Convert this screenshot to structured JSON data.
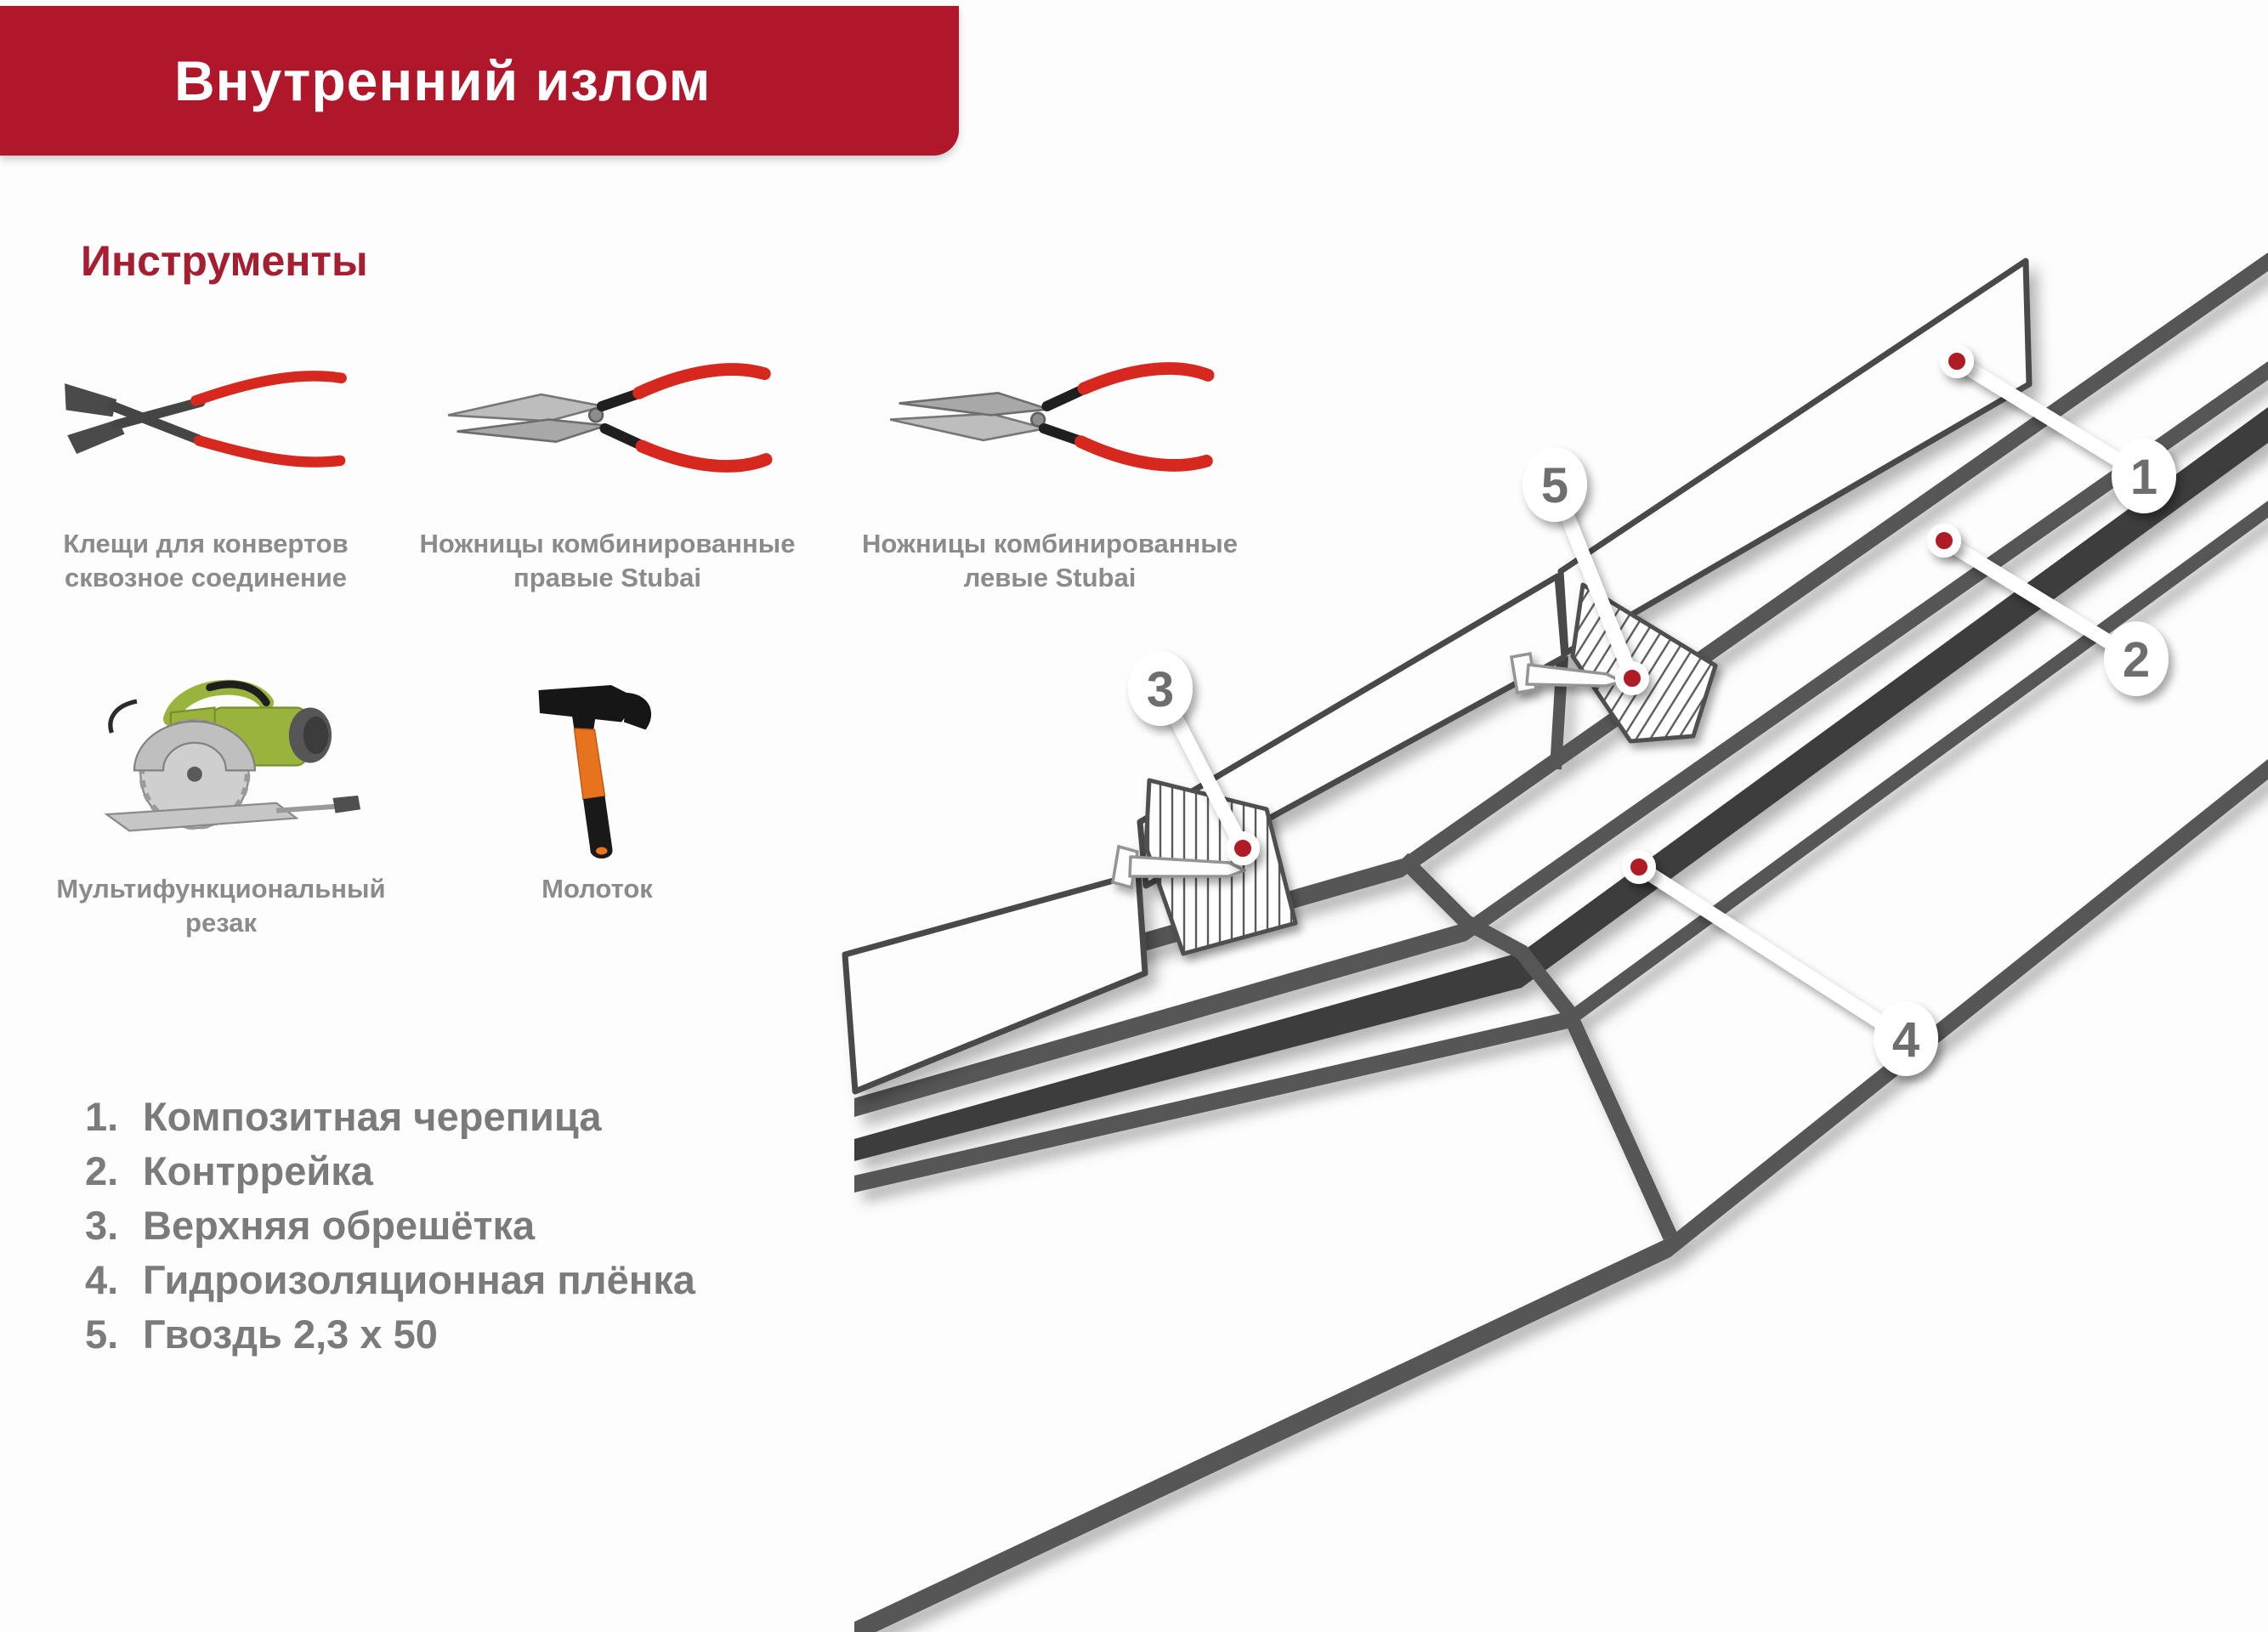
{
  "header": {
    "title": "Внутренний излом",
    "banner_color": "#b0172a",
    "title_color": "#ffffff"
  },
  "tools_section": {
    "heading": "Инструменты",
    "heading_color": "#a51e31",
    "label_color": "#8b8b8b",
    "tools": [
      {
        "icon": "seaming-pliers-icon",
        "label": "Клещи для конвертов\nсквозное соединение"
      },
      {
        "icon": "snips-right-icon",
        "label": "Ножницы комбинированные\nправые Stubai"
      },
      {
        "icon": "snips-left-icon",
        "label": "Ножницы комбинированные\nлевые Stubai"
      },
      {
        "icon": "circular-saw-icon",
        "label": "Мультифункциональный\nрезак"
      },
      {
        "icon": "hammer-icon",
        "label": "Молоток"
      }
    ]
  },
  "legend": {
    "text_color": "#7b7b7b",
    "items": [
      {
        "number": "1.",
        "text": "Композитная черепица"
      },
      {
        "number": "2.",
        "text": "Контррейка"
      },
      {
        "number": "3.",
        "text": "Верхняя обрешётка"
      },
      {
        "number": "4.",
        "text": "Гидроизоляционная плёнка"
      },
      {
        "number": "5.",
        "text": "Гвоздь 2,3 х 50"
      }
    ]
  },
  "diagram": {
    "marker_color": "#b01e28",
    "line_color": "#575757",
    "film_color": "#3d3d3d",
    "callouts": [
      {
        "number": "1"
      },
      {
        "number": "2"
      },
      {
        "number": "3"
      },
      {
        "number": "4"
      },
      {
        "number": "5"
      }
    ]
  }
}
